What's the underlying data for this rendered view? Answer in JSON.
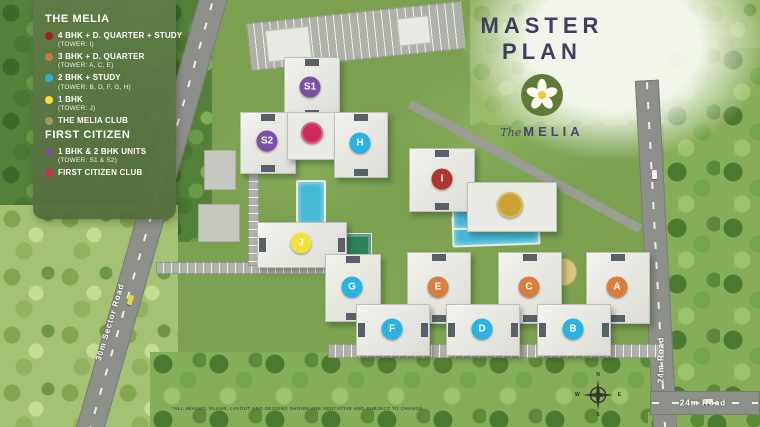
{
  "header": {
    "title": "MASTER PLAN",
    "logo_script": "The",
    "logo_name": "MELIA"
  },
  "legend": {
    "sections": [
      {
        "title": "THE MELIA",
        "items": [
          {
            "color": "#9e2025",
            "label": "4 BHK + D. QUARTER + STUDY",
            "sub": "(TOWER: I)"
          },
          {
            "color": "#c97a45",
            "label": "3 BHK + D. QUARTER",
            "sub": "(TOWER: A, C, E)"
          },
          {
            "color": "#29b3e2",
            "label": "2 BHK + STUDY",
            "sub": "(TOWER: B, D, F, G, H)"
          },
          {
            "color": "#f1e23b",
            "label": "1 BHK",
            "sub": "(TOWER: J)"
          },
          {
            "color": "#a3985c",
            "label": "THE MELIA CLUB",
            "sub": ""
          }
        ]
      },
      {
        "title": "FIRST CITIZEN",
        "items": [
          {
            "color": "#7b51a1",
            "label": "1 BHK & 2 BHK UNITS",
            "sub": "(TOWER: S1 & S2)"
          },
          {
            "color": "#ce2a5a",
            "label": "FIRST CITIZEN CLUB",
            "sub": ""
          }
        ]
      }
    ]
  },
  "map": {
    "towers": [
      {
        "id": "S1",
        "x": 310,
        "y": 87,
        "color": "#7b51a1"
      },
      {
        "id": "S2",
        "x": 267,
        "y": 141,
        "color": "#7b51a1"
      },
      {
        "id": "H",
        "x": 360,
        "y": 143,
        "color": "#29b3e2"
      },
      {
        "id": "I",
        "x": 442,
        "y": 179,
        "color": "#b23430"
      },
      {
        "id": "J",
        "x": 301,
        "y": 243,
        "color": "#f1e23b"
      },
      {
        "id": "G",
        "x": 352,
        "y": 287,
        "color": "#29b3e2"
      },
      {
        "id": "E",
        "x": 438,
        "y": 287,
        "color": "#d97f3e"
      },
      {
        "id": "C",
        "x": 529,
        "y": 287,
        "color": "#d97f3e"
      },
      {
        "id": "A",
        "x": 617,
        "y": 287,
        "color": "#d97f3e"
      },
      {
        "id": "F",
        "x": 392,
        "y": 329,
        "color": "#29b3e2"
      },
      {
        "id": "D",
        "x": 482,
        "y": 329,
        "color": "#29b3e2"
      },
      {
        "id": "B",
        "x": 573,
        "y": 329,
        "color": "#29b3e2"
      }
    ],
    "club_markers": [
      {
        "name": "first-citizen-club-marker",
        "x": 312,
        "y": 133,
        "d": 22,
        "color": "#ce2a5a"
      },
      {
        "name": "melia-club-marker",
        "x": 510,
        "y": 205,
        "d": 26,
        "color": "#c9a232"
      }
    ],
    "road_labels": [
      {
        "text": "30m Sector Road",
        "x": 110,
        "y": 322,
        "rotate": -73
      },
      {
        "text": "24m Road",
        "x": 661,
        "y": 360,
        "rotate": -90
      },
      {
        "text": "24m Road",
        "x": 703,
        "y": 403,
        "rotate": 0
      }
    ],
    "compass": {
      "n": "N",
      "e": "E",
      "s": "S",
      "w": "W"
    },
    "disclaimer": "*ALL IMAGES, PLANS, LAYOUT AND DESIGNS SHOWN ARE INDICATIVE AND SUBJECT TO CHANGE"
  }
}
